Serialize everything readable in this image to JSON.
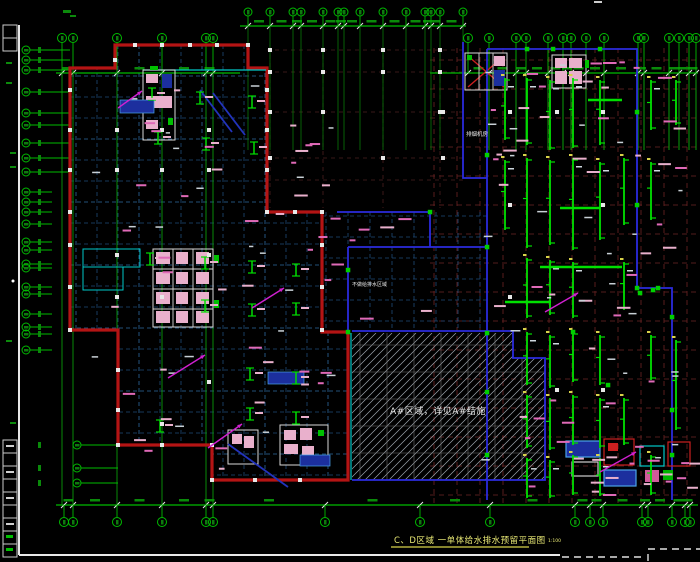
{
  "texts": {
    "title": "C、D区域 一单体给水排水预留平面图",
    "scale": "1:100",
    "hatch_note": "A#区域，详见A#结施",
    "center_note": "不做给排水区域",
    "room_label": "排烟机房"
  },
  "colors": {
    "background": "#000000",
    "grid_green": "#00bb00",
    "bright_green": "#00e000",
    "outline_red": "#b41414",
    "outline_blue": "#2b2bdd",
    "navy_dash": "#1e4a78",
    "navy_bright": "#2e6aa0",
    "darkred_dash": "#6e2424",
    "courtyard_dash": "#4a2020",
    "cyan": "#00c8c8",
    "pink": "#e06ab8",
    "pale_pink": "#e9b0cc",
    "magenta": "#d020d0",
    "white": "#e8e8e8",
    "yellow": "#d8d24a",
    "title_yellow": "#e8e874",
    "hatch_line": "#9aa2aa",
    "hatch_grid": "#6e6e6e",
    "dark_blue_fill": "#1c2f9e",
    "stair_blue": "#2233bb"
  },
  "drawing": {
    "grid": {
      "top_bubbles_main": {
        "y": 38,
        "r": 4.5,
        "xs": [
          62,
          73,
          117,
          162,
          206,
          213,
          468,
          489,
          516,
          526,
          548,
          563,
          571,
          586,
          604,
          638,
          644,
          669,
          679,
          689,
          696
        ]
      },
      "top_bubbles_mid": {
        "y": 12,
        "r": 4,
        "xs": [
          248,
          270,
          293,
          301,
          323,
          338,
          344,
          360,
          383,
          406,
          425,
          431,
          440,
          463
        ]
      },
      "bottom_bubbles": {
        "y": 522,
        "r": 4.5,
        "xs": [
          64,
          73,
          117,
          162,
          206,
          213,
          325,
          420,
          490,
          575,
          590,
          603,
          642,
          648,
          672,
          685,
          690
        ]
      },
      "left_bubbles_upper": {
        "x": 26,
        "r": 4,
        "ys": [
          50,
          60,
          70,
          92,
          113,
          125,
          143,
          158,
          172
        ]
      },
      "left_bubbles_mid": {
        "x": 26,
        "r": 4,
        "ys": [
          192,
          202,
          212,
          224,
          242,
          250,
          264,
          268,
          287,
          294,
          314,
          327,
          334,
          350
        ]
      },
      "left_bubbles_lower": {
        "x": 77,
        "r": 4,
        "ys": [
          445,
          468,
          483
        ]
      },
      "long_verticals": [
        62,
        73,
        117,
        162,
        206,
        213
      ],
      "right_verticals": [
        489,
        516,
        526,
        548,
        563,
        571,
        586,
        604,
        638,
        644,
        669,
        679,
        689,
        696
      ],
      "dim_line_main_y": 73,
      "dim_line_mid_y": 26,
      "dim_line_bottom_y": 505
    },
    "red_outline": "M70,68 H115 V45 H248 V68 H267 V212 H322 V332 H348 V480 H212 V445 H118 V330 H70 Z",
    "blue_lines": [
      "M487,49 H637 V288 H672 V500",
      "M487,49 V500",
      "M463,42 V178 H487",
      "M337,212 H430 V247",
      "M348,247 H487",
      "M348,247 V333",
      "M352,331 H513 V358 H545 V480 H352"
    ],
    "cyan_lines": [
      "M143,70 H266",
      "M351,333 V480"
    ],
    "hatch_polygon": "352,333 513,333 513,358 545,358 545,480 352,480",
    "beam_columns": [
      {
        "x": 505,
        "segs": [
          [
            78,
            140
          ],
          [
            160,
            230
          ]
        ]
      },
      {
        "x": 527,
        "segs": [
          [
            78,
            145
          ],
          [
            158,
            248
          ],
          [
            258,
            318
          ],
          [
            332,
            385
          ],
          [
            395,
            448
          ],
          [
            458,
            498
          ]
        ]
      },
      {
        "x": 550,
        "segs": [
          [
            80,
            150
          ],
          [
            160,
            245
          ],
          [
            260,
            315
          ],
          [
            335,
            388
          ],
          [
            398,
            450
          ],
          [
            460,
            498
          ]
        ]
      },
      {
        "x": 573,
        "segs": [
          [
            78,
            148
          ],
          [
            158,
            250
          ],
          [
            262,
            318
          ],
          [
            332,
            382
          ],
          [
            395,
            445
          ],
          [
            455,
            495
          ]
        ]
      },
      {
        "x": 600,
        "segs": [
          [
            80,
            145
          ],
          [
            162,
            240
          ],
          [
            335,
            385
          ],
          [
            398,
            448
          ],
          [
            458,
            496
          ]
        ]
      },
      {
        "x": 624,
        "segs": [
          [
            158,
            225
          ],
          [
            262,
            310
          ],
          [
            398,
            445
          ]
        ]
      },
      {
        "x": 651,
        "segs": [
          [
            80,
            130
          ],
          [
            162,
            220
          ],
          [
            335,
            380
          ],
          [
            455,
            495
          ]
        ]
      },
      {
        "x": 676,
        "segs": [
          [
            80,
            125
          ],
          [
            340,
            430
          ]
        ]
      }
    ],
    "green_bars": [
      [
        540,
        267,
        82
      ],
      [
        505,
        302,
        46
      ],
      [
        560,
        208,
        40
      ],
      [
        588,
        100,
        34
      ]
    ],
    "green_squares": [
      [
        487,
        155
      ],
      [
        487,
        247
      ],
      [
        487,
        333
      ],
      [
        487,
        392
      ],
      [
        487,
        455
      ],
      [
        527,
        49
      ],
      [
        553,
        49
      ],
      [
        600,
        49
      ],
      [
        637,
        112
      ],
      [
        637,
        205
      ],
      [
        637,
        288
      ],
      [
        658,
        288
      ],
      [
        672,
        317
      ],
      [
        672,
        410
      ],
      [
        672,
        455
      ],
      [
        348,
        270
      ],
      [
        348,
        332
      ],
      [
        430,
        212
      ],
      [
        573,
        332
      ],
      [
        608,
        385
      ],
      [
        640,
        293
      ],
      [
        653,
        290
      ]
    ],
    "left_clusters": [
      [
        152,
        88
      ],
      [
        200,
        92
      ],
      [
        252,
        96
      ],
      [
        158,
        132
      ],
      [
        206,
        138
      ],
      [
        254,
        142
      ],
      [
        150,
        253
      ],
      [
        205,
        257
      ],
      [
        252,
        261
      ],
      [
        296,
        264
      ],
      [
        205,
        300
      ],
      [
        252,
        304
      ],
      [
        296,
        303
      ],
      [
        250,
        368
      ],
      [
        296,
        372
      ],
      [
        250,
        408
      ],
      [
        296,
        412
      ],
      [
        160,
        420
      ]
    ],
    "white_squares": [
      [
        70,
        90
      ],
      [
        70,
        130
      ],
      [
        70,
        170
      ],
      [
        70,
        212
      ],
      [
        70,
        245
      ],
      [
        70,
        287
      ],
      [
        70,
        330
      ],
      [
        135,
        45
      ],
      [
        162,
        45
      ],
      [
        190,
        45
      ],
      [
        217,
        45
      ],
      [
        248,
        45
      ],
      [
        115,
        60
      ],
      [
        267,
        90
      ],
      [
        267,
        130
      ],
      [
        267,
        170
      ],
      [
        267,
        212
      ],
      [
        295,
        212
      ],
      [
        322,
        212
      ],
      [
        322,
        245
      ],
      [
        322,
        287
      ],
      [
        322,
        330
      ],
      [
        118,
        370
      ],
      [
        118,
        410
      ],
      [
        118,
        445
      ],
      [
        162,
        445
      ],
      [
        212,
        445
      ],
      [
        212,
        480
      ],
      [
        255,
        480
      ],
      [
        300,
        480
      ],
      [
        270,
        50
      ],
      [
        323,
        50
      ],
      [
        383,
        50
      ],
      [
        440,
        50
      ],
      [
        270,
        72
      ],
      [
        323,
        72
      ],
      [
        383,
        72
      ],
      [
        440,
        72
      ],
      [
        270,
        112
      ],
      [
        323,
        112
      ],
      [
        440,
        112
      ],
      [
        270,
        158
      ],
      [
        383,
        158
      ],
      [
        443,
        112
      ],
      [
        443,
        158
      ],
      [
        117,
        130
      ],
      [
        162,
        130
      ],
      [
        209,
        130
      ],
      [
        117,
        170
      ],
      [
        162,
        170
      ],
      [
        209,
        170
      ],
      [
        117,
        255
      ],
      [
        209,
        255
      ],
      [
        117,
        297
      ],
      [
        162,
        297
      ],
      [
        209,
        382
      ],
      [
        162,
        424
      ],
      [
        510,
        112
      ],
      [
        557,
        112
      ],
      [
        603,
        112
      ],
      [
        510,
        205
      ],
      [
        603,
        205
      ],
      [
        510,
        297
      ],
      [
        557,
        390
      ],
      [
        603,
        390
      ]
    ],
    "magenta_arrows": [
      [
        168,
        378,
        205,
        355
      ],
      [
        208,
        448,
        242,
        424
      ],
      [
        252,
        308,
        284,
        288
      ],
      [
        545,
        312,
        578,
        293
      ],
      [
        600,
        472,
        636,
        452
      ],
      [
        118,
        108,
        142,
        91
      ]
    ],
    "stair_diagonals": [
      [
        200,
        90,
        232,
        132
      ],
      [
        213,
        93,
        245,
        135
      ],
      [
        228,
        444,
        288,
        487
      ]
    ],
    "red_diagonals": [
      [
        468,
        56,
        504,
        87
      ],
      [
        468,
        87,
        504,
        56
      ]
    ],
    "cores": {
      "upper_left": {
        "outer": [
          143,
          70,
          32,
          70
        ],
        "pinks": [
          [
            146,
            74,
            12,
            9
          ],
          [
            146,
            96,
            14,
            12
          ],
          [
            160,
            96,
            12,
            12
          ],
          [
            146,
            120,
            12,
            9
          ]
        ],
        "dark_blue": [
          162,
          74,
          10,
          14
        ],
        "greens": [
          [
            150,
            66,
            8,
            4
          ],
          [
            168,
            118,
            5,
            7
          ]
        ]
      },
      "main_left": {
        "outer": [
          153,
          249,
          60,
          78
        ],
        "vlines": [
          173,
          193
        ],
        "hlines": [
          269,
          289,
          309
        ],
        "pinks": [
          [
            156,
            252,
            14,
            12
          ],
          [
            176,
            252,
            12,
            12
          ],
          [
            196,
            252,
            13,
            12
          ],
          [
            156,
            272,
            14,
            12
          ],
          [
            176,
            272,
            12,
            12
          ],
          [
            196,
            272,
            13,
            12
          ],
          [
            156,
            292,
            14,
            12
          ],
          [
            176,
            292,
            12,
            12
          ],
          [
            196,
            292,
            13,
            12
          ],
          [
            156,
            311,
            14,
            12
          ],
          [
            176,
            311,
            12,
            12
          ],
          [
            196,
            311,
            13,
            12
          ]
        ],
        "greens": [
          [
            214,
            255,
            5,
            8
          ],
          [
            214,
            300,
            5,
            8
          ]
        ]
      },
      "cyan_boxes": [
        [
          83,
          249,
          57,
          18
        ],
        [
          83,
          267,
          40,
          23
        ]
      ],
      "escalator": {
        "outer": [
          465,
          53,
          42,
          37
        ],
        "vlines": [
          479,
          493
        ],
        "pink": [
          494,
          56,
          11,
          10
        ],
        "dark_blue": [
          494,
          70,
          11,
          16
        ],
        "green": [
          467,
          55,
          5,
          5
        ]
      },
      "top_right": {
        "outer": [
          552,
          55,
          34,
          33
        ],
        "pinks": [
          [
            555,
            58,
            12,
            10
          ],
          [
            569,
            58,
            13,
            10
          ],
          [
            555,
            71,
            12,
            13
          ],
          [
            569,
            71,
            13,
            13
          ]
        ],
        "green": [
          585,
          60,
          4,
          8
        ]
      },
      "bottom_center_a": {
        "outer": [
          228,
          430,
          30,
          34
        ],
        "pinks": [
          [
            232,
            434,
            10,
            10
          ],
          [
            244,
            436,
            10,
            12
          ]
        ]
      },
      "bottom_center_b": {
        "outer": [
          280,
          425,
          48,
          40
        ],
        "pinks": [
          [
            284,
            430,
            12,
            10
          ],
          [
            300,
            428,
            12,
            12
          ],
          [
            284,
            444,
            14,
            10
          ],
          [
            302,
            446,
            12,
            10
          ]
        ],
        "green": [
          318,
          430,
          6,
          6
        ]
      },
      "mech_room": [
        {
          "x": 566,
          "y": 441,
          "w": 34,
          "h": 16,
          "fill": "#1c2f9e",
          "stroke": "#4aa3e8"
        },
        {
          "x": 604,
          "y": 439,
          "w": 30,
          "h": 26,
          "stroke": "#cc2020"
        },
        {
          "x": 608,
          "y": 443,
          "w": 10,
          "h": 8,
          "fill": "#cc2020"
        },
        {
          "x": 640,
          "y": 446,
          "w": 24,
          "h": 20,
          "stroke": "#00c8c8"
        },
        {
          "x": 668,
          "y": 442,
          "w": 22,
          "h": 24,
          "stroke": "#cc2020"
        },
        {
          "x": 572,
          "y": 462,
          "w": 26,
          "h": 14,
          "stroke": "#cfcfcf"
        },
        {
          "x": 604,
          "y": 470,
          "w": 32,
          "h": 16,
          "fill": "#1c2f9e",
          "stroke": "#4aa3e8"
        },
        {
          "x": 645,
          "y": 470,
          "w": 14,
          "h": 12,
          "fill": "#d05a9a"
        },
        {
          "x": 663,
          "y": 470,
          "w": 10,
          "h": 10,
          "fill": "#00b400"
        }
      ]
    },
    "dark_blue_blobs": [
      [
        120,
        100,
        34,
        13
      ],
      [
        268,
        372,
        36,
        12
      ],
      [
        300,
        455,
        30,
        11
      ]
    ],
    "pink_dash_regions": [
      [
        82,
        78,
        270,
        230,
        26
      ],
      [
        120,
        340,
        220,
        130,
        14
      ],
      [
        470,
        55,
        220,
        200,
        28
      ],
      [
        490,
        260,
        200,
        235,
        24
      ],
      [
        330,
        214,
        150,
        112,
        8
      ],
      [
        550,
        440,
        145,
        55,
        10
      ]
    ],
    "white_dash_regions": [
      [
        475,
        60,
        215,
        430,
        26
      ],
      [
        90,
        85,
        255,
        370,
        20
      ]
    ],
    "frame": {
      "v_line_x": 19,
      "v_line_y1": 25,
      "v_line_y2": 555,
      "h_line_y": 555,
      "h_solid_x2": 560,
      "title_cells_top": [
        25,
        38
      ],
      "title_cells_bottom": [
        440,
        453,
        466,
        479,
        492,
        505,
        518,
        531,
        544
      ],
      "margin_green_dashes": [
        [
          6,
          62
        ],
        [
          6,
          82
        ],
        [
          10,
          152
        ],
        [
          10,
          166
        ],
        [
          6,
          340
        ],
        [
          10,
          422
        ]
      ],
      "white_dot": [
        13,
        281
      ]
    },
    "title_underline": [
      391,
      547,
      529,
      547
    ]
  }
}
